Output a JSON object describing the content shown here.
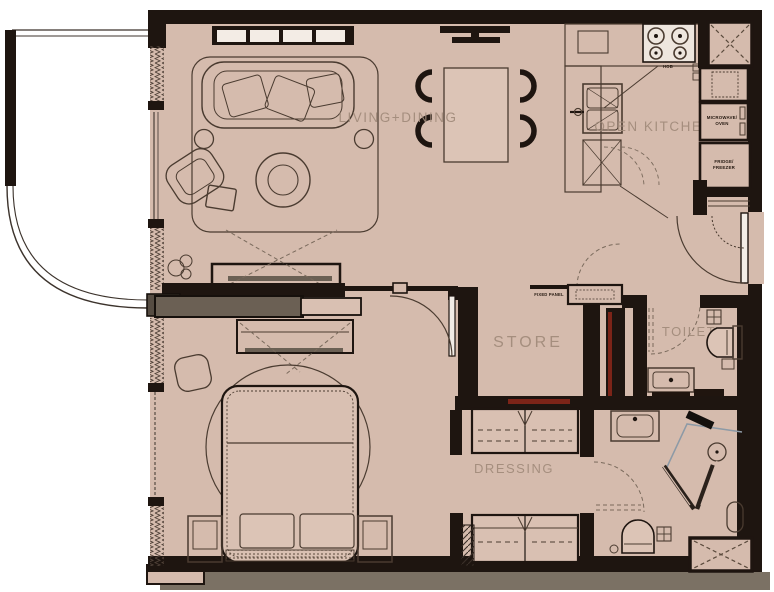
{
  "plan": {
    "type": "apartment-floor-plan",
    "rooms": {
      "living_dining": {
        "label": "LIVING+DINING"
      },
      "open_kitchen": {
        "label": "OPEN KITCHEN"
      },
      "store": {
        "label": "STORE"
      },
      "toilet": {
        "label": "TOILET"
      },
      "dressing": {
        "label": "DRESSING"
      },
      "bedroom": {
        "label": ""
      }
    },
    "appliances": {
      "hob": "HOB",
      "microwave_line1": "MICROWAVE/",
      "microwave_line2": "OVEN",
      "fridge_line1": "FRIDGE/",
      "fridge_line2": "FREEZER"
    },
    "annotations": {
      "fixed_panel": "FIXED PANEL"
    },
    "colors": {
      "floor": "#d5bbad",
      "floor_light": "#dcc4b6",
      "wall": "#1e1510",
      "sliding_door_gray": "#6b6054",
      "bottom_band_gray": "#7b7164",
      "red_accent": "#7c2418",
      "label_text": "#a18b7b",
      "furniture_line": "#4a3b30",
      "shower_glass": "#8d9aa6",
      "balcony": "#ffffff"
    }
  }
}
